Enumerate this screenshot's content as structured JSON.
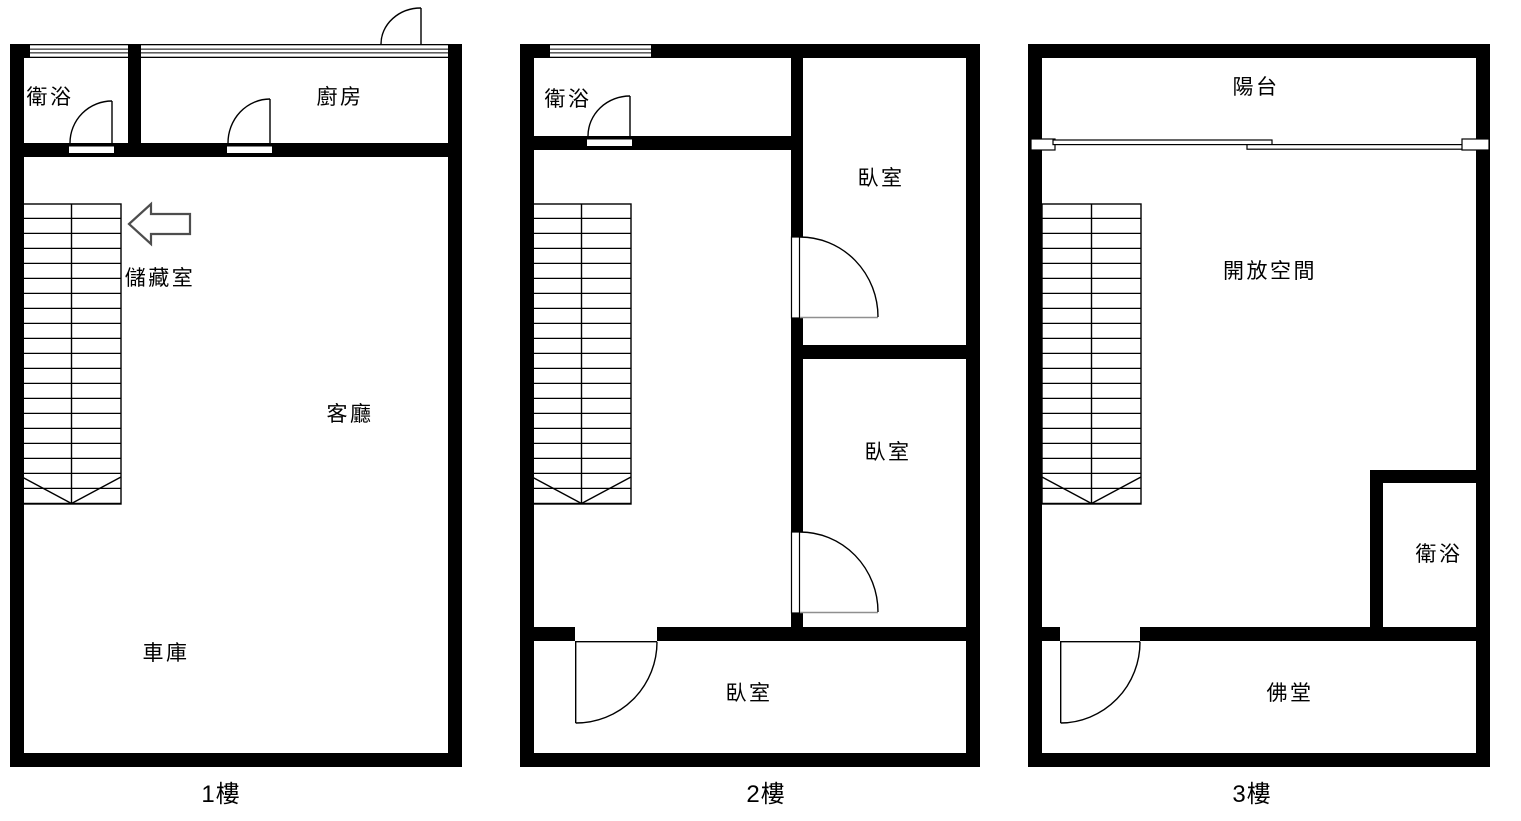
{
  "title": "三層樓平面圖",
  "colors": {
    "bg": "#ffffff",
    "wall": "#000000",
    "line": "#000000",
    "door-open-line": "#8f8f8f",
    "arrow-outline": "#4d4d4d",
    "text": "#000000"
  },
  "floors": [
    {
      "name": "floor-1",
      "label": "1樓",
      "rooms": [
        {
          "key": "bathroom",
          "label": "衛浴"
        },
        {
          "key": "kitchen",
          "label": "廚房"
        },
        {
          "key": "storage",
          "label": "儲藏室"
        },
        {
          "key": "living-room",
          "label": "客廳"
        },
        {
          "key": "garage",
          "label": "車庫"
        }
      ],
      "icons": [
        {
          "name": "left-arrow-icon",
          "meaning": "stair direction pointer"
        }
      ]
    },
    {
      "name": "floor-2",
      "label": "2樓",
      "rooms": [
        {
          "key": "bathroom",
          "label": "衛浴"
        },
        {
          "key": "bedroom-upper",
          "label": "臥室"
        },
        {
          "key": "bedroom-middle",
          "label": "臥室"
        },
        {
          "key": "bedroom-lower",
          "label": "臥室"
        }
      ]
    },
    {
      "name": "floor-3",
      "label": "3樓",
      "rooms": [
        {
          "key": "balcony",
          "label": "陽台"
        },
        {
          "key": "open-space",
          "label": "開放空間"
        },
        {
          "key": "bathroom",
          "label": "衛浴"
        },
        {
          "key": "buddhist-hall",
          "label": "佛堂"
        }
      ]
    }
  ]
}
